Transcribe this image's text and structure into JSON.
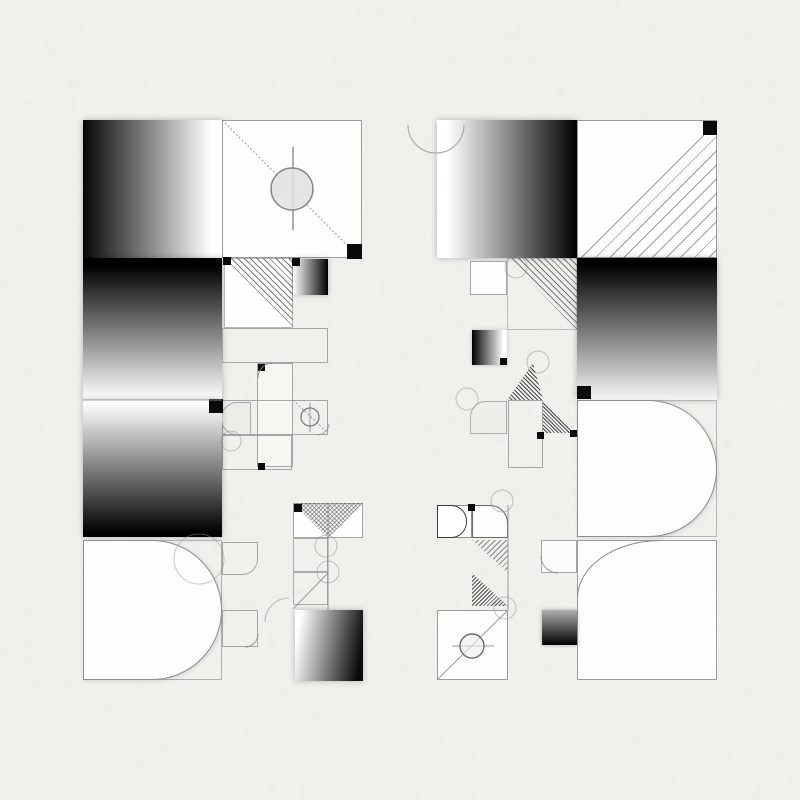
{
  "canvas": {
    "width": 800,
    "height": 800,
    "background": "#f2f1ee"
  },
  "palette": {
    "ink": "#0a0a0a",
    "paper": "#fdfdfc",
    "line_gray": "#8f8f8f",
    "border_gray": "#a5a5a5",
    "hatch_gray": "#5a5a5a",
    "tile_fill": "#ecece9"
  },
  "shapes": [
    {
      "name": "left-gradient-square-top",
      "x": 83,
      "y": 120,
      "w": 139,
      "h": 138,
      "bg": "linear-gradient(to right,#060606,#ffffff 92%)",
      "shadow": "0 0 6px rgba(0,0,0,0.28)"
    },
    {
      "name": "left-outline-square-top",
      "x": 222,
      "y": 120,
      "w": 140,
      "h": 138,
      "bg": "#fdfdfc",
      "border": "1px solid #9b9b9b"
    },
    {
      "name": "left-gradient-square-upper-mid",
      "x": 83,
      "y": 258,
      "w": 139,
      "h": 142,
      "bg": "linear-gradient(to bottom,#000000 5%,#f8f8f6 97%)",
      "shadow": "0 0 6px rgba(0,0,0,0.28)"
    },
    {
      "name": "left-hatch-square",
      "x": 224,
      "y": 258,
      "w": 69,
      "h": 70,
      "bg": "#fefefe",
      "border": "1px solid #b8b8b8"
    },
    {
      "name": "left-hatch-triangle",
      "x": 224,
      "y": 258,
      "w": 69,
      "h": 70,
      "bg": "repeating-linear-gradient(45deg,rgba(70,70,70,0.7) 0 1px,transparent 1px 4.5px)",
      "clip": "polygon(0 0,100% 0,100% 100%)"
    },
    {
      "name": "left-mini-gradient-tile",
      "x": 293,
      "y": 259,
      "w": 35,
      "h": 36,
      "bg": "linear-gradient(to right,#ffffff,#000000)",
      "shadow": "0 0 5px rgba(0,0,0,0.25)"
    },
    {
      "name": "left-wide-outline-rect",
      "x": 222,
      "y": 328,
      "w": 106,
      "h": 35,
      "border": "1px solid #a5a5a5"
    },
    {
      "name": "left-vertical-strip",
      "x": 257,
      "y": 363,
      "w": 36,
      "h": 104,
      "bg": "#f6f6f3",
      "border": "1px solid #a5a5a5"
    },
    {
      "name": "left-mid-row-rect",
      "x": 222,
      "y": 400,
      "w": 106,
      "h": 35,
      "border": "1px solid #a5a5a5"
    },
    {
      "name": "left-capsule-tile",
      "x": 221,
      "y": 402,
      "w": 30,
      "h": 33,
      "bg": "#ecece9",
      "border": "1px solid #a8a8a8",
      "radius": "16px 0 0 16px"
    },
    {
      "name": "left-lower-outline-rect",
      "x": 222,
      "y": 435,
      "w": 70,
      "h": 35,
      "border": "1px solid #a5a5a5"
    },
    {
      "name": "left-gradient-square-lower-mid",
      "x": 83,
      "y": 400,
      "w": 139,
      "h": 137,
      "bg": "linear-gradient(to bottom,#fdfdfd 3%,#000000 97%)",
      "shadow": "0 0 6px rgba(0,0,0,0.28)"
    },
    {
      "name": "left-bottom-outline-square",
      "x": 83,
      "y": 540,
      "w": 139,
      "h": 140,
      "border": "1px solid #b0b0b0"
    },
    {
      "name": "left-d-shape",
      "x": 83,
      "y": 540,
      "w": 139,
      "h": 140,
      "bg": "#fdfdfc",
      "border": "1px solid #8f8f8f",
      "radius": "0 70px 70px 0",
      "shadow": "1px 1px 4px rgba(0,0,0,0.12)"
    },
    {
      "name": "left-rounded-tile",
      "x": 222,
      "y": 542,
      "w": 36,
      "h": 33,
      "bg": "#f0f0ed",
      "border": "1px solid #a5a5a5",
      "radius": "0 0 16px 0"
    },
    {
      "name": "left-small-outline-square",
      "x": 222,
      "y": 610,
      "w": 36,
      "h": 37,
      "border": "1px solid #a5a5a5"
    },
    {
      "name": "left-checker-rect",
      "x": 293,
      "y": 503,
      "w": 70,
      "h": 35,
      "bg": "#fefefe",
      "border": "1px solid #a5a5a5"
    },
    {
      "name": "left-checker-triangle-a",
      "x": 293,
      "y": 503,
      "w": 35,
      "h": 35,
      "bg": "repeating-linear-gradient(45deg,rgba(90,90,90,0.55) 0 1px,transparent 1px 3px),repeating-linear-gradient(135deg,rgba(90,90,90,0.55) 0 1px,transparent 1px 3px)",
      "clip": "polygon(0 0,100% 0,100% 100%)"
    },
    {
      "name": "left-checker-triangle-b",
      "x": 328,
      "y": 503,
      "w": 35,
      "h": 35,
      "bg": "repeating-linear-gradient(45deg,rgba(90,90,90,0.55) 0 1px,transparent 1px 3px),repeating-linear-gradient(135deg,rgba(90,90,90,0.55) 0 1px,transparent 1px 3px)",
      "clip": "polygon(0 0,100% 0,0 100%)"
    },
    {
      "name": "left-strip-outline-a",
      "x": 293,
      "y": 538,
      "w": 35,
      "h": 34,
      "border": "1px solid #ababab"
    },
    {
      "name": "left-strip-outline-b",
      "x": 293,
      "y": 572,
      "w": 35,
      "h": 33,
      "border": "1px solid #ababab"
    },
    {
      "name": "left-gradient-square-bottom",
      "x": 295,
      "y": 610,
      "w": 68,
      "h": 71,
      "bg": "linear-gradient(100deg,#ffffff 8%,#0a0a0a 92%)",
      "shadow": "0 0 6px rgba(0,0,0,0.25)"
    },
    {
      "name": "right-gradient-square-top",
      "x": 437,
      "y": 120,
      "w": 140,
      "h": 138,
      "bg": "linear-gradient(to right,#ffffff 8%,#000000)",
      "shadow": "0 0 6px rgba(0,0,0,0.28)"
    },
    {
      "name": "right-hatch-square-top",
      "x": 577,
      "y": 120,
      "w": 140,
      "h": 138,
      "bg": "#fefefe",
      "border": "1px solid #9b9b9b"
    },
    {
      "name": "right-hatch-triangle-top",
      "x": 577,
      "y": 120,
      "w": 140,
      "h": 138,
      "bg": "repeating-linear-gradient(135deg,rgba(95,95,95,0.6) 0 1px,transparent 1px 10px)",
      "clip": "polygon(100% 0,100% 100%,0 100%)"
    },
    {
      "name": "right-gradient-square-mid",
      "x": 577,
      "y": 258,
      "w": 140,
      "h": 142,
      "bg": "linear-gradient(to bottom,#000000 4%,#f1f1ef 98%)",
      "shadow": "0 0 6px rgba(0,0,0,0.28)"
    },
    {
      "name": "right-small-outline-square",
      "x": 470,
      "y": 261,
      "w": 37,
      "h": 34,
      "bg": "#fdfdfc",
      "border": "1px solid #a5a5a5"
    },
    {
      "name": "right-hatch-square-mid",
      "x": 507,
      "y": 258,
      "w": 70,
      "h": 72,
      "border": "1px solid #bbbbbb"
    },
    {
      "name": "right-hatch-triangle-mid",
      "x": 507,
      "y": 258,
      "w": 70,
      "h": 72,
      "bg": "repeating-linear-gradient(45deg,rgba(70,70,70,0.7) 0 1px,transparent 1px 4.5px)",
      "clip": "polygon(0 0,100% 0,100% 100%)"
    },
    {
      "name": "right-mini-gradient-tile",
      "x": 472,
      "y": 330,
      "w": 35,
      "h": 35,
      "bg": "linear-gradient(to right,#000000,#ffffff 90%)",
      "shadow": "0 0 4px rgba(0,0,0,0.2)"
    },
    {
      "name": "right-hatch-triangle-small",
      "x": 507,
      "y": 363,
      "w": 36,
      "h": 37,
      "bg": "repeating-linear-gradient(45deg,rgba(45,45,45,0.85) 0 1px,transparent 1px 3px)",
      "clip": "polygon(72% 0,100% 100%,0 100%)"
    },
    {
      "name": "right-vertical-strip",
      "x": 508,
      "y": 400,
      "w": 35,
      "h": 68,
      "border": "1px solid #a5a5a5"
    },
    {
      "name": "right-capsule-tile",
      "x": 470,
      "y": 401,
      "w": 37,
      "h": 33,
      "bg": "#eeeeeb",
      "border": "1px solid #ababab",
      "radius": "16px 0 0 0"
    },
    {
      "name": "right-hatch-triangle-b",
      "x": 543,
      "y": 401,
      "w": 31,
      "h": 32,
      "bg": "repeating-linear-gradient(45deg,rgba(45,45,45,0.85) 0 1px,transparent 1px 2.6px)",
      "clip": "polygon(0 0,100% 100%,0 100%)"
    },
    {
      "name": "right-mid-outline-square",
      "x": 577,
      "y": 400,
      "w": 140,
      "h": 137,
      "border": "1px solid #b5b5b5"
    },
    {
      "name": "right-d-shape",
      "x": 577,
      "y": 400,
      "w": 140,
      "h": 137,
      "bg": "#fdfdfc",
      "border": "1px solid #8f8f8f",
      "radius": "0 70px 69px 0",
      "shadow": "1px 1px 4px rgba(0,0,0,0.12)"
    },
    {
      "name": "right-bottom-square",
      "x": 577,
      "y": 540,
      "w": 140,
      "h": 140,
      "bg": "#fdfdfc",
      "border": "1px solid #9b9b9b"
    },
    {
      "name": "right-s-curve",
      "x": 577,
      "y": 540,
      "w": 84,
      "h": 58,
      "radius": "100% 0 0 0",
      "borderTop": "1.3px solid #8a8a8a",
      "borderLeft": "1.3px solid #8a8a8a"
    },
    {
      "name": "right-rounded-corner-tile",
      "x": 541,
      "y": 540,
      "w": 36,
      "h": 33,
      "bg": "#fbfbfa",
      "border": "1px solid #a5a5a5"
    },
    {
      "name": "right-small-gradient-tile",
      "x": 542,
      "y": 610,
      "w": 35,
      "h": 35,
      "bg": "linear-gradient(to bottom,#b0b0b0,#000000)",
      "shadow": "0 0 4px rgba(0,0,0,0.3)"
    },
    {
      "name": "right-mini-d-outline-square",
      "x": 437,
      "y": 505,
      "w": 35,
      "h": 33,
      "bg": "#fdfdfc",
      "border": "1px solid #8f8f8f"
    },
    {
      "name": "right-mini-d-tile",
      "x": 437,
      "y": 505,
      "w": 30,
      "h": 33,
      "bg": "#ffffff",
      "border": "1.4px solid #3a3a3a",
      "radius": "0 16px 16px 0"
    },
    {
      "name": "right-rounded-tr-tile",
      "x": 472,
      "y": 505,
      "w": 36,
      "h": 33,
      "bg": "#fdfdfc",
      "border": "1.3px solid #666666",
      "radius": "0 18px 0 0"
    },
    {
      "name": "right-mini-hatch-a",
      "x": 472,
      "y": 540,
      "w": 36,
      "h": 33,
      "bg": "repeating-linear-gradient(135deg,rgba(80,80,80,0.65) 0 1px,transparent 1px 4px)",
      "clip": "polygon(0 0,100% 0,100% 100%)"
    },
    {
      "name": "right-mini-hatch-b",
      "x": 472,
      "y": 573,
      "w": 36,
      "h": 33,
      "bg": "repeating-linear-gradient(135deg,rgba(50,50,50,0.85) 0 1px,transparent 1px 2.8px)",
      "clip": "polygon(0 0,100% 100%,0 100%)"
    },
    {
      "name": "right-compass-square",
      "x": 437,
      "y": 610,
      "w": 71,
      "h": 70,
      "bg": "#fdfdfc",
      "border": "1px solid #9b9b9b"
    },
    {
      "name": "corner-marker-1",
      "x": 347,
      "y": 244,
      "w": 15,
      "h": 15,
      "bg": "#0a0a0a"
    },
    {
      "name": "corner-marker-2",
      "x": 223,
      "y": 257,
      "w": 8,
      "h": 8,
      "bg": "#0a0a0a"
    },
    {
      "name": "corner-marker-3",
      "x": 292,
      "y": 258,
      "w": 8,
      "h": 8,
      "bg": "#0a0a0a"
    },
    {
      "name": "corner-marker-4",
      "x": 209,
      "y": 399,
      "w": 14,
      "h": 14,
      "bg": "#0a0a0a"
    },
    {
      "name": "corner-marker-5",
      "x": 258,
      "y": 364,
      "w": 7,
      "h": 7,
      "bg": "#0a0a0a"
    },
    {
      "name": "corner-marker-6",
      "x": 258,
      "y": 463,
      "w": 7,
      "h": 7,
      "bg": "#0a0a0a"
    },
    {
      "name": "corner-marker-7",
      "x": 294,
      "y": 504,
      "w": 8,
      "h": 8,
      "bg": "#0a0a0a"
    },
    {
      "name": "corner-marker-8",
      "x": 703,
      "y": 121,
      "w": 14,
      "h": 14,
      "bg": "#0a0a0a"
    },
    {
      "name": "corner-marker-9",
      "x": 577,
      "y": 386,
      "w": 14,
      "h": 13,
      "bg": "#0a0a0a"
    },
    {
      "name": "corner-marker-10",
      "x": 500,
      "y": 358,
      "w": 7,
      "h": 7,
      "bg": "#0a0a0a"
    },
    {
      "name": "corner-marker-11",
      "x": 537,
      "y": 432,
      "w": 7,
      "h": 7,
      "bg": "#0a0a0a"
    },
    {
      "name": "corner-marker-12",
      "x": 570,
      "y": 430,
      "w": 7,
      "h": 7,
      "bg": "#0a0a0a"
    },
    {
      "name": "corner-marker-13",
      "x": 468,
      "y": 504,
      "w": 7,
      "h": 7,
      "bg": "#0a0a0a"
    }
  ],
  "lines": [
    {
      "name": "left-square-diagonal",
      "x1": 222,
      "y1": 120,
      "x2": 346,
      "y2": 244,
      "dash": "2 2"
    },
    {
      "name": "left-square-vertical-axis",
      "x1": 293,
      "y1": 147,
      "x2": 293,
      "y2": 230,
      "w": 1.6
    },
    {
      "name": "left-band-seam",
      "x1": 83,
      "y1": 400,
      "x2": 222,
      "y2": 400
    },
    {
      "name": "left-mini-diagonal",
      "x1": 293,
      "y1": 400,
      "x2": 328,
      "y2": 433,
      "dash": "2 2"
    },
    {
      "name": "left-mini-compass-axis",
      "x1": 310,
      "y1": 403,
      "x2": 310,
      "y2": 432
    },
    {
      "name": "left-strip-vertical",
      "x1": 328,
      "y1": 503,
      "x2": 328,
      "y2": 610
    },
    {
      "name": "left-strip-diagonal",
      "x1": 293,
      "y1": 609,
      "x2": 328,
      "y2": 573
    },
    {
      "name": "right-group-vertical",
      "x1": 508,
      "y1": 505,
      "x2": 508,
      "y2": 610
    },
    {
      "name": "right-compass-diagonal",
      "x1": 438,
      "y1": 679,
      "x2": 507,
      "y2": 611
    },
    {
      "name": "right-compass-axis",
      "x1": 452,
      "y1": 646,
      "x2": 494,
      "y2": 646
    }
  ],
  "circles": [
    {
      "name": "left-big-circle",
      "cx": 292,
      "cy": 189,
      "r": 21,
      "fill": "rgba(225,225,225,0.85)",
      "stroke": "#868686",
      "sw": 1.5
    },
    {
      "name": "left-mini-compass-circle",
      "cx": 310,
      "cy": 417,
      "r": 9,
      "stroke": "#7d7d7d",
      "sw": 1.3
    },
    {
      "name": "left-capsule-arc",
      "cx": 231,
      "cy": 441,
      "r": 10,
      "opacity": 0.55
    },
    {
      "name": "left-d-overlap-arc",
      "cx": 199,
      "cy": 559,
      "r": 25,
      "opacity": 0.5
    },
    {
      "name": "left-strip-circle-a",
      "cx": 326,
      "cy": 546,
      "r": 11,
      "opacity": 0.5
    },
    {
      "name": "left-strip-circle-b",
      "cx": 328,
      "cy": 572,
      "r": 11,
      "opacity": 0.5
    },
    {
      "name": "right-hatch-arc",
      "cx": 516,
      "cy": 267,
      "r": 11,
      "opacity": 0.5
    },
    {
      "name": "right-triangle-arc",
      "cx": 538,
      "cy": 362,
      "r": 11,
      "opacity": 0.5
    },
    {
      "name": "right-capsule-arc",
      "cx": 467,
      "cy": 399,
      "r": 11,
      "opacity": 0.5
    },
    {
      "name": "right-mini-tile-arc",
      "cx": 502,
      "cy": 501,
      "r": 11,
      "opacity": 0.55
    },
    {
      "name": "right-compass-corner-arc",
      "cx": 505,
      "cy": 608,
      "r": 11,
      "opacity": 0.55
    },
    {
      "name": "right-compass-circle",
      "cx": 472,
      "cy": 646,
      "r": 12,
      "stroke": "#6e6e6e",
      "sw": 1.4,
      "fill": "rgba(238,238,238,0.6)"
    }
  ],
  "paths": [
    {
      "name": "right-top-corner-circle",
      "d": "M408,125 A28,28 0 1 0 464,125",
      "opacity": 0.75
    },
    {
      "name": "left-strip-corner-arc",
      "d": "M258,378 A15,15 0 0 1 273,363",
      "opacity": 0.8
    },
    {
      "name": "left-compass-corner-arc",
      "d": "M317,435 A12,12 0 0 0 329,424",
      "opacity": 0.7
    },
    {
      "name": "left-tile-corner-arc",
      "d": "M258,634 A13,13 0 0 1 245,647",
      "opacity": 0.8
    },
    {
      "name": "left-gradient-corner-arc",
      "d": "M289,598 A24,24 0 0 0 265,622",
      "opacity": 0.6
    },
    {
      "name": "right-tile-corner-arc",
      "d": "M541,556 A17,17 0 0 0 558,573",
      "opacity": 0.8
    }
  ]
}
